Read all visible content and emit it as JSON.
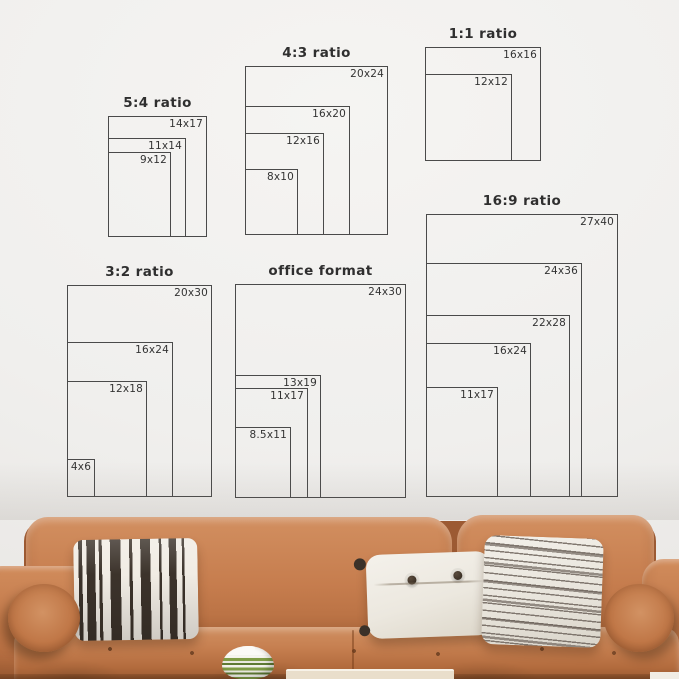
{
  "diagrams": [
    {
      "title": "5:4 ratio",
      "sizes": [
        "14x17",
        "11x14",
        "9x12"
      ]
    },
    {
      "title": "4:3 ratio",
      "sizes": [
        "20x24",
        "16x20",
        "12x16",
        "8x10"
      ]
    },
    {
      "title": "1:1 ratio",
      "sizes": [
        "16x16",
        "12x12"
      ]
    },
    {
      "title": "3:2 ratio",
      "sizes": [
        "20x30",
        "16x24",
        "12x18",
        "4x6"
      ]
    },
    {
      "title": "office format",
      "sizes": [
        "24x30",
        "13x19",
        "11x17",
        "8.5x11"
      ]
    },
    {
      "title": "16:9 ratio",
      "sizes": [
        "27x40",
        "24x36",
        "22x28",
        "16x24",
        "11x17"
      ]
    }
  ],
  "palette": {
    "wall": "#f0efed",
    "diagram_line": "#4a4a4a",
    "diagram_text": "#2f2f2f",
    "leather": "#c57c4e",
    "leather_dark": "#9c5a33",
    "pillow_white": "#efece5",
    "stripe_dark": "#3c332b",
    "stripe_gray": "#8d847a",
    "vase_green": "#7e9b45",
    "table": "#e9decb"
  },
  "couch": {
    "pillow_names": [
      "black-white-striped-pillow",
      "white-button-lumbar-pillow",
      "gray-striped-pillow"
    ],
    "bolster_count": 2
  }
}
